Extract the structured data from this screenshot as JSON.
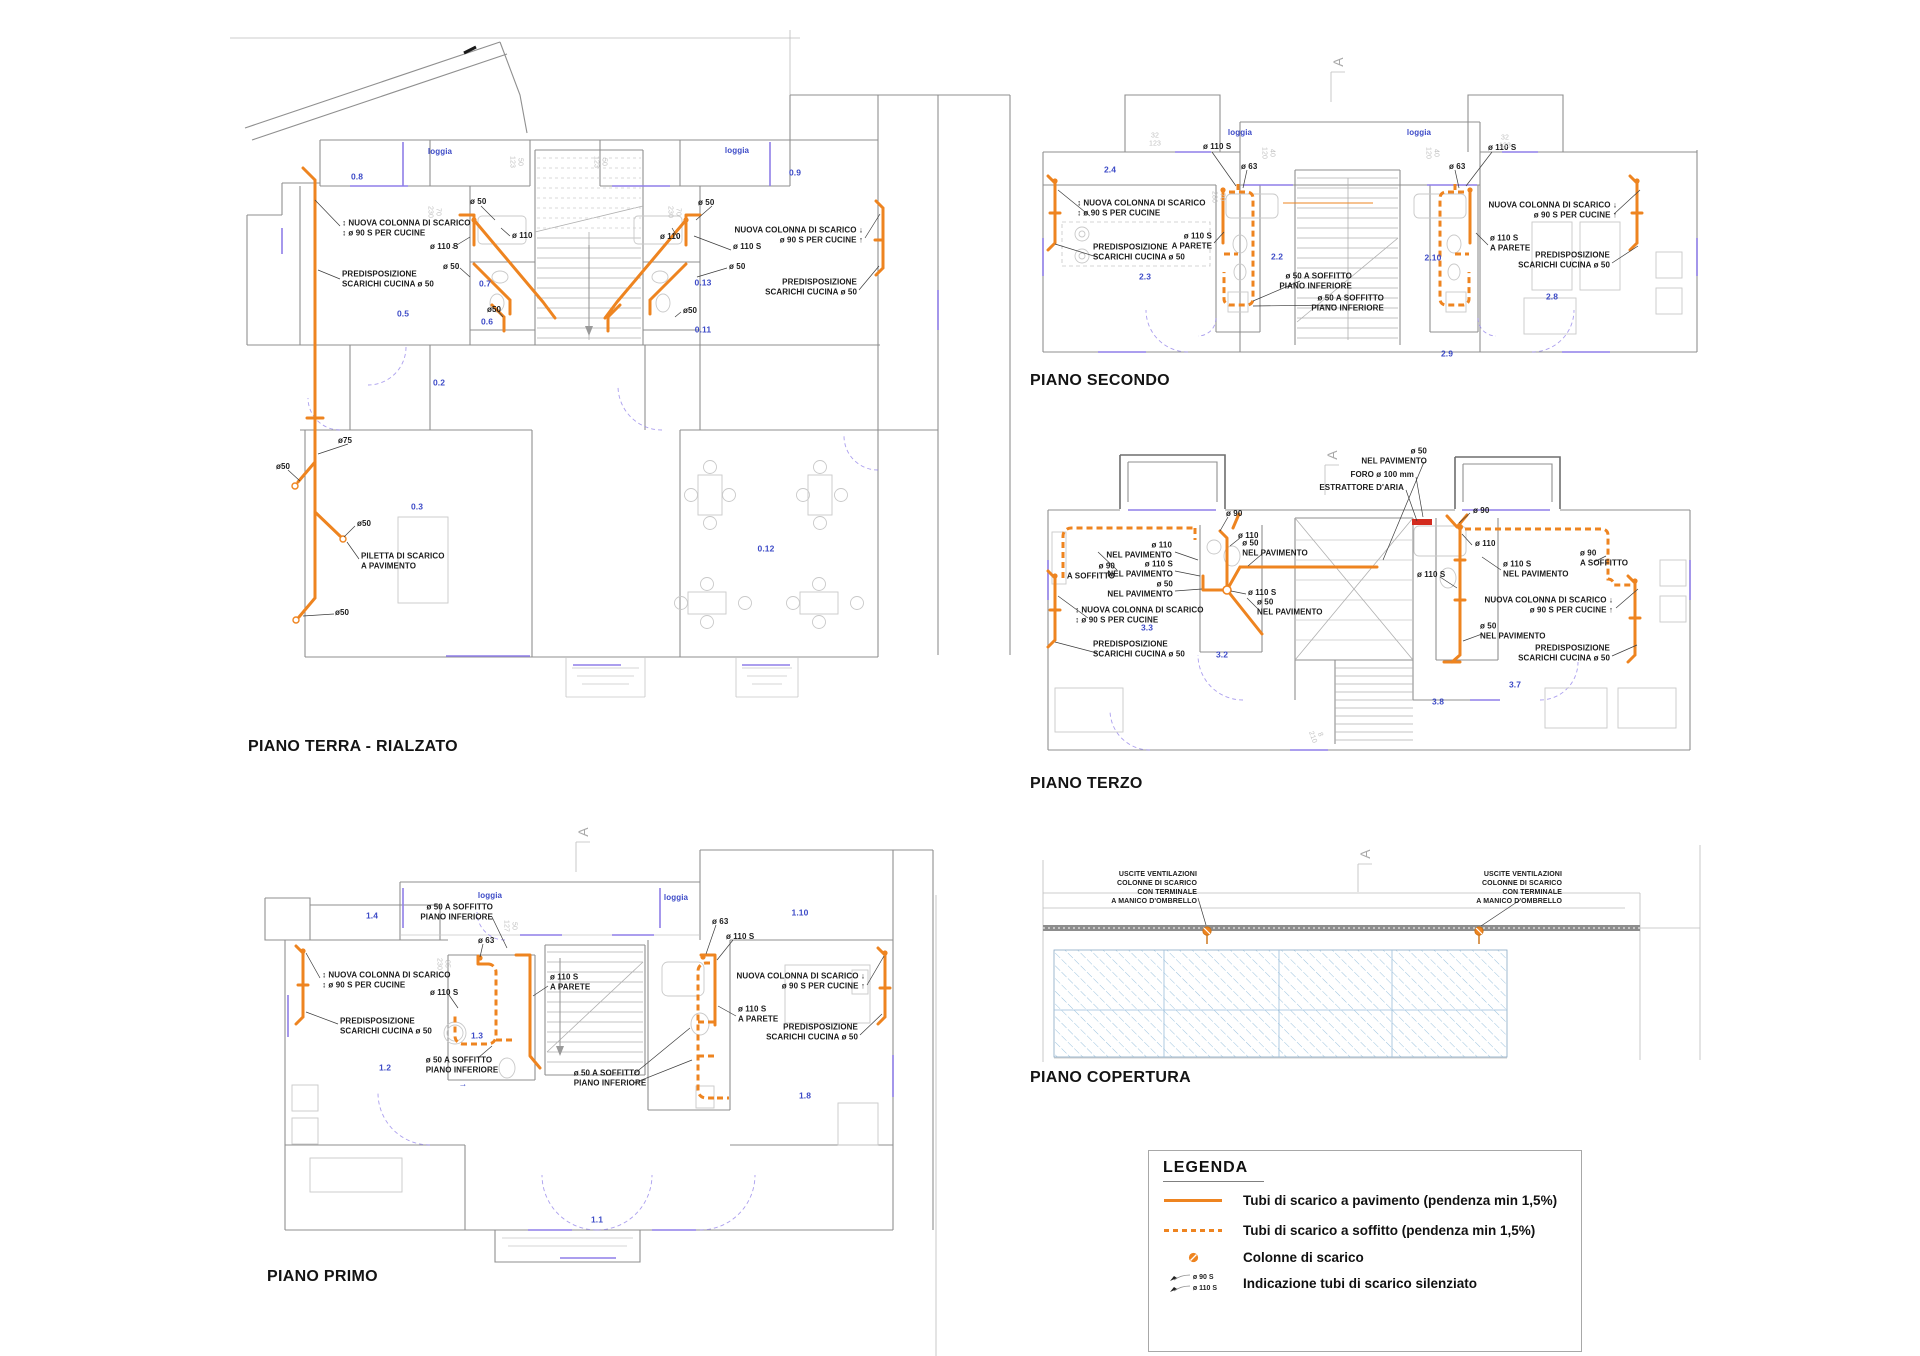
{
  "colors": {
    "pipe_orange": "#EE8420",
    "room_label_blue": "#3D4BC7",
    "window_purple": "#8F7FE8",
    "roof_hatch_blue": "#9CC3DE",
    "extractor_red": "#D32B1E"
  },
  "titles": {
    "terra": "PIANO TERRA - RIALZATO",
    "secondo": "PIANO SECONDO",
    "terzo": "PIANO TERZO",
    "primo": "PIANO PRIMO",
    "copertura": "PIANO COPERTURA"
  },
  "legend": {
    "title": "LEGENDA",
    "items": [
      {
        "icon": "pipe-floor-line",
        "label": "Tubi di scarico a pavimento (pendenza min 1,5%)"
      },
      {
        "icon": "pipe-ceiling-dashed-line",
        "label": "Tubi di scarico a soffitto (pendenza min 1,5%)"
      },
      {
        "icon": "drain-column-dot",
        "label": "Colonne di scarico"
      },
      {
        "icon": "silenced-pipe-arrows",
        "label": "Indicazione tubi di scarico silenziato",
        "sub1": "ø 90 S",
        "sub2": "ø 110 S"
      }
    ]
  },
  "annotations": [
    {
      "t": "0.8",
      "x": 357,
      "y": 177,
      "c": "room"
    },
    {
      "t": "0.5",
      "x": 403,
      "y": 314,
      "c": "room"
    },
    {
      "t": "0.7",
      "x": 485,
      "y": 284,
      "c": "room"
    },
    {
      "t": "0.6",
      "x": 487,
      "y": 322,
      "c": "room"
    },
    {
      "t": "0.2",
      "x": 439,
      "y": 383,
      "c": "room"
    },
    {
      "t": "0.3",
      "x": 417,
      "y": 507,
      "c": "room"
    },
    {
      "t": "0.9",
      "x": 795,
      "y": 173,
      "c": "room"
    },
    {
      "t": "0.13",
      "x": 703,
      "y": 283,
      "c": "room"
    },
    {
      "t": "0.11",
      "x": 703,
      "y": 330,
      "c": "room"
    },
    {
      "t": "0.12",
      "x": 766,
      "y": 549,
      "c": "room"
    },
    {
      "t": "loggia",
      "x": 440,
      "y": 152,
      "c": "loggia"
    },
    {
      "t": "loggia",
      "x": 737,
      "y": 151,
      "c": "loggia"
    },
    {
      "t": "↕ NUOVA COLONNA DI SCARICO\n↕ ø 90 S PER CUCINE",
      "x": 342,
      "y": 229,
      "a": "left"
    },
    {
      "t": "PREDISPOSIZIONE\nSCARICHI CUCINA ø 50",
      "x": 342,
      "y": 280,
      "a": "left"
    },
    {
      "t": "ø 110 S",
      "x": 430,
      "y": 247,
      "a": "left"
    },
    {
      "t": "ø 50",
      "x": 470,
      "y": 202,
      "a": "left"
    },
    {
      "t": "ø 110",
      "x": 512,
      "y": 236,
      "a": "left"
    },
    {
      "t": "ø 50",
      "x": 443,
      "y": 267,
      "a": "left"
    },
    {
      "t": "ø50",
      "x": 487,
      "y": 310,
      "a": "left"
    },
    {
      "t": "ø 50",
      "x": 698,
      "y": 203,
      "a": "left"
    },
    {
      "t": "ø 110",
      "x": 660,
      "y": 237,
      "a": "left"
    },
    {
      "t": "ø 110 S",
      "x": 733,
      "y": 247,
      "a": "left"
    },
    {
      "t": "ø 50",
      "x": 729,
      "y": 267,
      "a": "left"
    },
    {
      "t": "ø50",
      "x": 683,
      "y": 311,
      "a": "left"
    },
    {
      "t": "NUOVA COLONNA DI SCARICO ↓\nø 90 S PER CUCINE ↑",
      "x": 863,
      "y": 236,
      "a": "right"
    },
    {
      "t": "PREDISPOSIZIONE\nSCARICHI CUCINA ø 50",
      "x": 857,
      "y": 288,
      "a": "right"
    },
    {
      "t": "ø75",
      "x": 338,
      "y": 441,
      "a": "left"
    },
    {
      "t": "ø50",
      "x": 276,
      "y": 467,
      "a": "left"
    },
    {
      "t": "ø50",
      "x": 357,
      "y": 524,
      "a": "left"
    },
    {
      "t": "PILETTA DI SCARICO\nA PAVIMENTO",
      "x": 361,
      "y": 562,
      "a": "left"
    },
    {
      "t": "ø50",
      "x": 335,
      "y": 613,
      "a": "left"
    },
    {
      "t": "50\n123",
      "x": 516,
      "y": 162,
      "c": "dim",
      "r": 90
    },
    {
      "t": "70\n230",
      "x": 434,
      "y": 212,
      "c": "dim",
      "r": 90
    },
    {
      "t": "50\n123",
      "x": 600,
      "y": 162,
      "c": "dim",
      "r": 90
    },
    {
      "t": "70\n230",
      "x": 674,
      "y": 212,
      "c": "dim",
      "r": 90
    },
    {
      "t": "2.4",
      "x": 1110,
      "y": 170,
      "c": "room"
    },
    {
      "t": "2.3",
      "x": 1145,
      "y": 277,
      "c": "room"
    },
    {
      "t": "2.2",
      "x": 1277,
      "y": 257,
      "c": "room"
    },
    {
      "t": "2.10",
      "x": 1433,
      "y": 258,
      "c": "room"
    },
    {
      "t": "2.8",
      "x": 1552,
      "y": 297,
      "c": "room"
    },
    {
      "t": "2.9",
      "x": 1447,
      "y": 354,
      "c": "room"
    },
    {
      "t": "loggia",
      "x": 1240,
      "y": 133,
      "c": "loggia"
    },
    {
      "t": "loggia",
      "x": 1419,
      "y": 133,
      "c": "loggia"
    },
    {
      "t": "ø 110 S",
      "x": 1203,
      "y": 147,
      "a": "left"
    },
    {
      "t": "ø 63",
      "x": 1241,
      "y": 167,
      "a": "left"
    },
    {
      "t": "↕ NUOVA COLONNA DI SCARICO\n↕ ø 90 S PER CUCINE",
      "x": 1077,
      "y": 209,
      "a": "left"
    },
    {
      "t": "PREDISPOSIZIONE\nSCARICHI CUCINA ø 50",
      "x": 1093,
      "y": 253,
      "a": "left"
    },
    {
      "t": "ø 110 S\nA PARETE",
      "x": 1212,
      "y": 242,
      "a": "right"
    },
    {
      "t": "ø 50 A SOFFITTO\nPIANO INFERIORE",
      "x": 1352,
      "y": 282,
      "a": "right"
    },
    {
      "t": "ø 50 A SOFFITTO\nPIANO INFERIORE",
      "x": 1384,
      "y": 304,
      "a": "right"
    },
    {
      "t": "ø 63",
      "x": 1449,
      "y": 167,
      "a": "left"
    },
    {
      "t": "ø 110 S",
      "x": 1488,
      "y": 148,
      "a": "left"
    },
    {
      "t": "NUOVA COLONNA DI SCARICO ↓\nø 90 S PER CUCINE ↑",
      "x": 1617,
      "y": 211,
      "a": "right"
    },
    {
      "t": "ø 110 S\nA PARETE",
      "x": 1490,
      "y": 244,
      "a": "left"
    },
    {
      "t": "PREDISPOSIZIONE\nSCARICHI CUCINA ø 50",
      "x": 1610,
      "y": 261,
      "a": "right"
    },
    {
      "t": "32\n123",
      "x": 1155,
      "y": 140,
      "c": "dim"
    },
    {
      "t": "40\n120",
      "x": 1268,
      "y": 153,
      "c": "dim",
      "r": 90
    },
    {
      "t": "70\n280",
      "x": 1218,
      "y": 197,
      "c": "dim",
      "r": 90
    },
    {
      "t": "32\n123",
      "x": 1505,
      "y": 142,
      "c": "dim"
    },
    {
      "t": "40\n120",
      "x": 1432,
      "y": 153,
      "c": "dim",
      "r": 90
    },
    {
      "t": "A",
      "x": 1338,
      "y": 62,
      "c": "amark",
      "r": -90
    },
    {
      "t": "3.3",
      "x": 1147,
      "y": 628,
      "c": "room"
    },
    {
      "t": "3.2",
      "x": 1222,
      "y": 655,
      "c": "room"
    },
    {
      "t": "3.8",
      "x": 1438,
      "y": 702,
      "c": "room"
    },
    {
      "t": "3.7",
      "x": 1515,
      "y": 685,
      "c": "room"
    },
    {
      "t": "ø 50\nNEL PAVIMENTO",
      "x": 1427,
      "y": 457,
      "a": "right"
    },
    {
      "t": "FORO ø 100 mm",
      "x": 1414,
      "y": 475,
      "a": "right"
    },
    {
      "t": "ESTRATTORE D'ARIA",
      "x": 1404,
      "y": 488,
      "a": "right"
    },
    {
      "t": "ø 90",
      "x": 1226,
      "y": 514,
      "a": "left"
    },
    {
      "t": "ø 110",
      "x": 1238,
      "y": 536,
      "a": "left"
    },
    {
      "t": "ø 110\nNEL PAVIMENTO",
      "x": 1172,
      "y": 551,
      "a": "right"
    },
    {
      "t": "ø 50\nNEL PAVIMENTO",
      "x": 1275,
      "y": 549
    },
    {
      "t": "ø 110 S\nNEL PAVIMENTO",
      "x": 1173,
      "y": 570,
      "a": "right"
    },
    {
      "t": "ø 90\nA SOFFITTO",
      "x": 1115,
      "y": 572,
      "a": "right"
    },
    {
      "t": "ø 50\nNEL PAVIMENTO",
      "x": 1173,
      "y": 590,
      "a": "right"
    },
    {
      "t": "ø 110 S",
      "x": 1248,
      "y": 593,
      "a": "left"
    },
    {
      "t": "ø 50\nNEL PAVIMENTO",
      "x": 1257,
      "y": 608,
      "a": "left"
    },
    {
      "t": "↕ NUOVA COLONNA DI SCARICO\n↕ ø 90 S PER CUCINE",
      "x": 1075,
      "y": 616,
      "a": "left"
    },
    {
      "t": "PREDISPOSIZIONE\nSCARICHI CUCINA ø 50",
      "x": 1093,
      "y": 650,
      "a": "left"
    },
    {
      "t": "ø 110 S",
      "x": 1417,
      "y": 575,
      "a": "left"
    },
    {
      "t": "ø 90",
      "x": 1473,
      "y": 511,
      "a": "left"
    },
    {
      "t": "ø 110",
      "x": 1475,
      "y": 544,
      "a": "left"
    },
    {
      "t": "ø 110 S\nNEL PAVIMENTO",
      "x": 1503,
      "y": 570,
      "a": "left"
    },
    {
      "t": "ø 90\nA SOFFITTO",
      "x": 1580,
      "y": 559,
      "a": "left"
    },
    {
      "t": "NUOVA COLONNA DI SCARICO ↓\nø 90 S PER CUCINE ↑",
      "x": 1613,
      "y": 606,
      "a": "right"
    },
    {
      "t": "ø 50\nNEL PAVIMENTO",
      "x": 1480,
      "y": 632,
      "a": "left"
    },
    {
      "t": "PREDISPOSIZIONE\nSCARICHI CUCINA ø 50",
      "x": 1610,
      "y": 654,
      "a": "right"
    },
    {
      "t": "8\n210",
      "x": 1316,
      "y": 736,
      "c": "dim",
      "r": 70
    },
    {
      "t": "A",
      "x": 1332,
      "y": 455,
      "c": "amark",
      "r": -90
    },
    {
      "t": "1.4",
      "x": 372,
      "y": 916,
      "c": "room"
    },
    {
      "t": "1.3",
      "x": 477,
      "y": 1036,
      "c": "room"
    },
    {
      "t": "1.2",
      "x": 385,
      "y": 1068,
      "c": "room"
    },
    {
      "t": "1.10",
      "x": 800,
      "y": 913,
      "c": "room"
    },
    {
      "t": "1.8",
      "x": 805,
      "y": 1096,
      "c": "room"
    },
    {
      "t": "1.1",
      "x": 597,
      "y": 1220,
      "c": "room"
    },
    {
      "t": "loggia",
      "x": 490,
      "y": 896,
      "c": "loggia"
    },
    {
      "t": "loggia",
      "x": 676,
      "y": 898,
      "c": "loggia"
    },
    {
      "t": "→",
      "x": 463,
      "y": 1084,
      "c": "room"
    },
    {
      "t": "ø 50 A SOFFITTO\nPIANO INFERIORE",
      "x": 493,
      "y": 913,
      "a": "right"
    },
    {
      "t": "ø 63",
      "x": 478,
      "y": 941,
      "a": "left"
    },
    {
      "t": "↕ NUOVA COLONNA DI SCARICO\n↕ ø 90 S PER CUCINE",
      "x": 322,
      "y": 981,
      "a": "left"
    },
    {
      "t": "ø 110 S",
      "x": 430,
      "y": 993,
      "a": "left"
    },
    {
      "t": "PREDISPOSIZIONE\nSCARICHI CUCINA ø 50",
      "x": 340,
      "y": 1027,
      "a": "left"
    },
    {
      "t": "ø 110 S\nA PARETE",
      "x": 550,
      "y": 983,
      "a": "left"
    },
    {
      "t": "ø 50 A SOFFITTO\nPIANO INFERIORE",
      "x": 462,
      "y": 1066
    },
    {
      "t": "ø 63",
      "x": 712,
      "y": 922,
      "a": "left"
    },
    {
      "t": "ø 110 S",
      "x": 726,
      "y": 937,
      "a": "left"
    },
    {
      "t": "NUOVA COLONNA DI SCARICO ↓\nø 90 S PER CUCINE ↑",
      "x": 865,
      "y": 982,
      "a": "right"
    },
    {
      "t": "ø 110 S\nA PARETE",
      "x": 738,
      "y": 1015,
      "a": "left"
    },
    {
      "t": "PREDISPOSIZIONE\nSCARICHI CUCINA ø 50",
      "x": 858,
      "y": 1033,
      "a": "right"
    },
    {
      "t": "ø 50 A SOFFITTO\nPIANO INFERIORE",
      "x": 610,
      "y": 1079
    },
    {
      "t": "50\n127",
      "x": 510,
      "y": 926,
      "c": "dim",
      "r": 90
    },
    {
      "t": "85\n230",
      "x": 443,
      "y": 964,
      "c": "dim",
      "r": 90
    },
    {
      "t": "A",
      "x": 583,
      "y": 832,
      "c": "amark",
      "r": -90
    },
    {
      "t": "USCITE VENTILAZIONI\nCOLONNE DI SCARICO\nCON TERMINALE\nA MANICO D'OMBRELLO",
      "x": 1197,
      "y": 888,
      "a": "right",
      "s": 7
    },
    {
      "t": "USCITE VENTILAZIONI\nCOLONNE DI SCARICO\nCON TERMINALE\nA MANICO D'OMBRELLO",
      "x": 1562,
      "y": 888,
      "a": "right",
      "s": 7
    },
    {
      "t": "A",
      "x": 1365,
      "y": 854,
      "c": "amark",
      "r": -90
    }
  ]
}
